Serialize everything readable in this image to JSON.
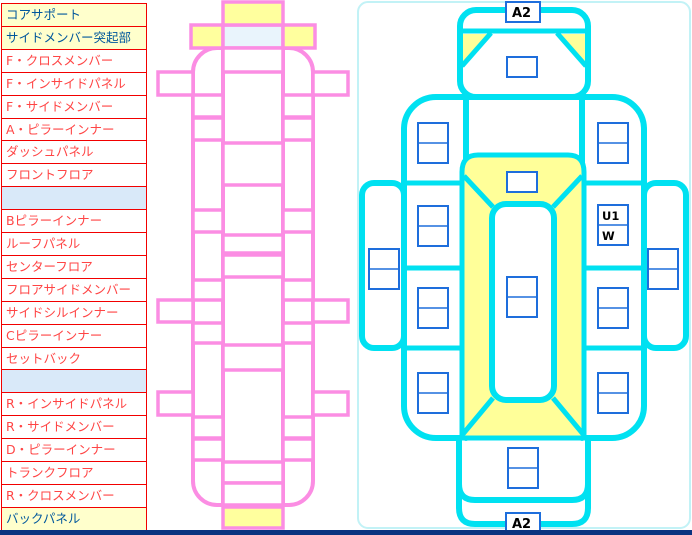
{
  "window": {
    "background": "#ffffff",
    "bottom_bar_color": "#0a3380"
  },
  "parts_list": {
    "rows": [
      {
        "label": "コアサポート",
        "highlight": "yellow"
      },
      {
        "label": "サイドメンバー突起部",
        "highlight": "yellow"
      },
      {
        "label": "F・クロスメンバー",
        "highlight": "none"
      },
      {
        "label": "F・インサイドパネル",
        "highlight": "none"
      },
      {
        "label": "F・サイドメンバー",
        "highlight": "none"
      },
      {
        "label": "A・ピラーインナー",
        "highlight": "none"
      },
      {
        "label": "ダッシュパネル",
        "highlight": "none"
      },
      {
        "label": "フロントフロア",
        "highlight": "none"
      },
      {
        "label": "",
        "highlight": "empty"
      },
      {
        "label": "Bピラーインナー",
        "highlight": "none"
      },
      {
        "label": "ルーフパネル",
        "highlight": "none"
      },
      {
        "label": "センターフロア",
        "highlight": "none"
      },
      {
        "label": "フロアサイドメンバー",
        "highlight": "none"
      },
      {
        "label": "サイドシルインナー",
        "highlight": "none"
      },
      {
        "label": "Cピラーインナー",
        "highlight": "none"
      },
      {
        "label": "セットバック",
        "highlight": "none"
      },
      {
        "label": "",
        "highlight": "empty"
      },
      {
        "label": "R・インサイドパネル",
        "highlight": "none"
      },
      {
        "label": "R・サイドメンバー",
        "highlight": "none"
      },
      {
        "label": "D・ピラーインナー",
        "highlight": "none"
      },
      {
        "label": "トランクフロア",
        "highlight": "none"
      },
      {
        "label": "R・クロスメンバー",
        "highlight": "none"
      },
      {
        "label": "バックパネル",
        "highlight": "yellow"
      }
    ],
    "colors": {
      "border": "#f20000",
      "text_normal": "#ff4545",
      "text_highlight": "#00579c",
      "bg_highlight": "#ffffcc",
      "bg_empty": "#d9e9f9"
    }
  },
  "left_diagram": {
    "description": "vehicle unibody top view (pink outline)",
    "outline_color": "#fb8de3",
    "body_fill": "#e9f4fc",
    "highlight_fill": "#ffff9e"
  },
  "right_diagram": {
    "description": "vehicle damage input diagram (cyan outline)",
    "outline_color": "#00e1f1",
    "highlight_fill": "#ffff99",
    "cell_border": "#1e6edc",
    "front_code": "A2",
    "rear_code": "A2",
    "code_u1": "U1",
    "code_w": "W"
  }
}
